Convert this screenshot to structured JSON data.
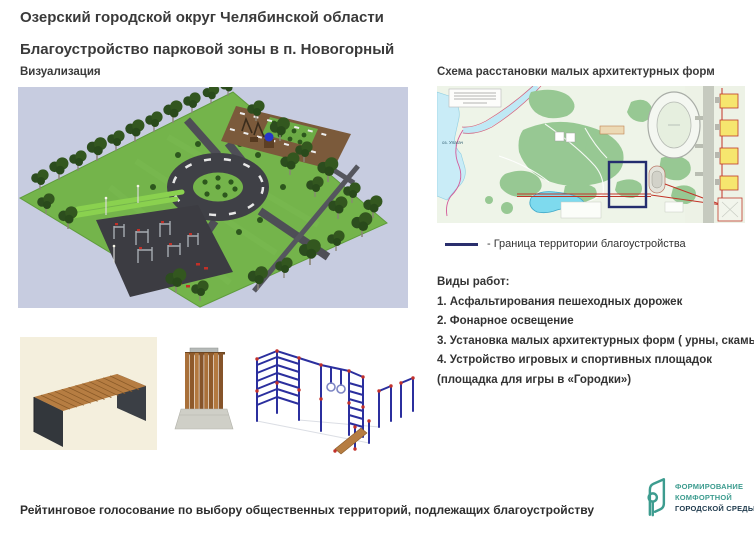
{
  "page": {
    "title_line1": "Озерский городской округ Челябинской области",
    "title_line2": "Благоустройство парковой зоны в п. Новогорный",
    "footer_note": "Рейтинговое голосование по выбору общественных территорий, подлежащих благоустройству"
  },
  "visualization": {
    "label": "Визуализация"
  },
  "scheme": {
    "label": "Схема расстановки малых архитектурных форм",
    "lake_label": "оз. Улагач",
    "legend_text": "- Граница  территории благоустройства"
  },
  "works": {
    "heading": "Виды работ:",
    "items": [
      "1. Асфальтирования пешеходных дорожек",
      "2. Фонарное освещение",
      "3. Установка малых архитектурных форм ( урны, скамьи)",
      "4. Устройство игровых и спортивных площадок",
      "(площадка для игры в «Городки»)"
    ]
  },
  "gallery": {
    "items": [
      "bench",
      "trash-urn",
      "workout-complex"
    ]
  },
  "logo": {
    "icon": "ribbon-leaf-icon",
    "line1": "ФОРМИРОВАНИЕ",
    "line2": "КОМФОРТНОЙ",
    "line3": "ГОРОДСКОЙ СРЕДЫ"
  },
  "colors": {
    "accent_teal": "#3d9c8f",
    "boundary_navy": "#2a2f6d",
    "map_forest": "#97c893",
    "map_water": "#c9ecf7",
    "park_grass": "#74b44b"
  }
}
